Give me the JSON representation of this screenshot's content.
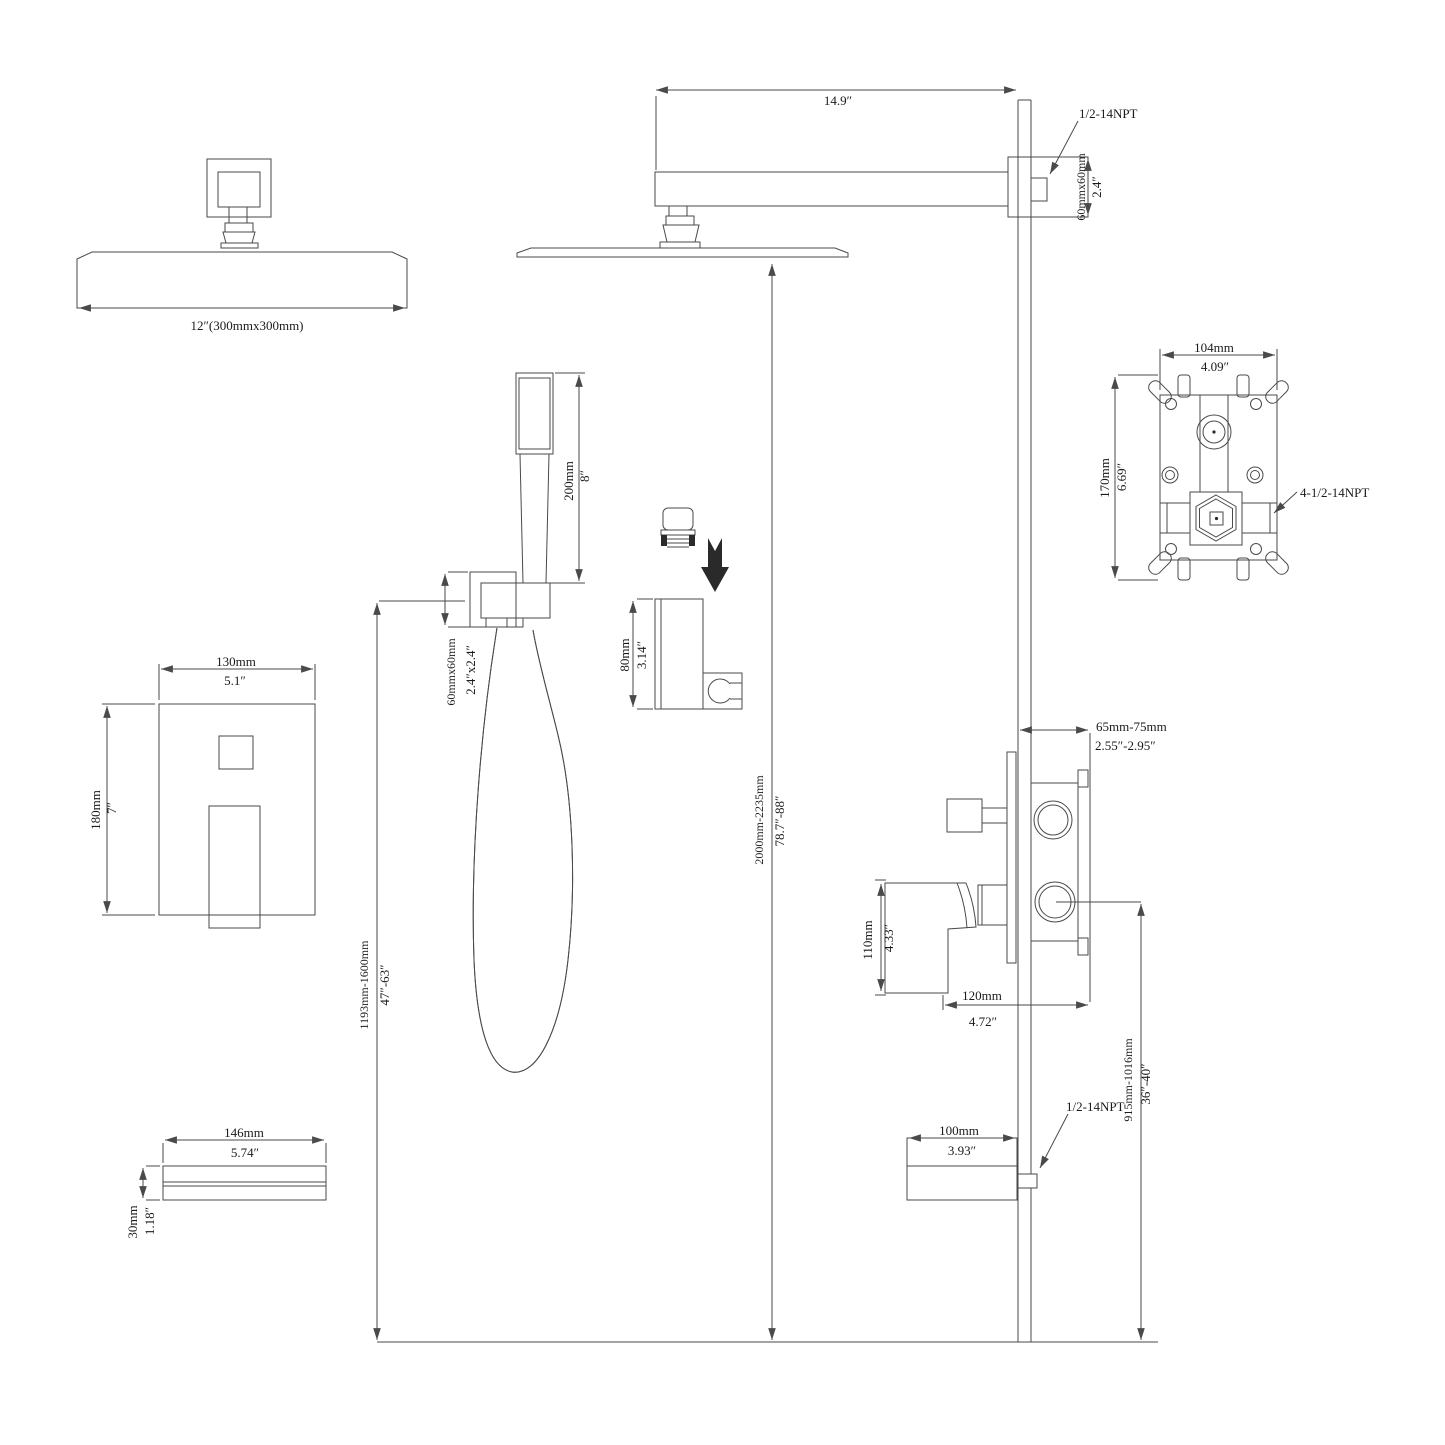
{
  "page": {
    "background": "#ffffff",
    "ink": "#4a4a4a",
    "kind": "shower-system-installation-dimension-drawing"
  },
  "rain_shower_front": {
    "size_label": "12″(300mmx300mm)"
  },
  "shower_arm": {
    "length_in": "14.9″",
    "thread_label": "1/2-14NPT",
    "wall_box_mm": "60mmx60mm",
    "wall_box_in": "2.4″"
  },
  "rough_in_valve": {
    "width_mm": "104mm",
    "width_in": "4.09″",
    "height_mm": "170mm",
    "height_in": "6.69″",
    "thread_label": "4-1/2-14NPT"
  },
  "trim_plate": {
    "width_mm": "130mm",
    "width_in": "5.1″",
    "height_mm": "180mm",
    "height_in": "7″"
  },
  "hand_shower": {
    "length_mm": "200mm",
    "length_in": "8″",
    "outlet_mm": "60mmx60mm",
    "outlet_in": "2.4″x2.4″",
    "holder_mm": "80mm",
    "holder_in": "3.14″"
  },
  "heights": {
    "head_to_floor_mm": "2000mm-2235mm",
    "head_to_floor_in": "78.7″-88″",
    "outlet_to_floor_mm": "1193mm-1600mm",
    "outlet_to_floor_in": "47″-63″",
    "valve_to_floor_mm": "915mm-1016mm",
    "valve_to_floor_in": "36″-40″"
  },
  "valve_trim": {
    "depth_mm": "65mm-75mm",
    "depth_in": "2.55″-2.95″",
    "handle_height_mm": "110mm",
    "handle_height_in": "4.33″",
    "handle_length_mm": "120mm",
    "handle_length_in": "4.72″"
  },
  "tub_spout": {
    "thread_label": "1/2-14NPT",
    "reach_mm": "100mm",
    "reach_in": "3.93″",
    "length_mm": "146mm",
    "length_in": "5.74″",
    "height_mm": "30mm",
    "height_in": "1.18″"
  }
}
